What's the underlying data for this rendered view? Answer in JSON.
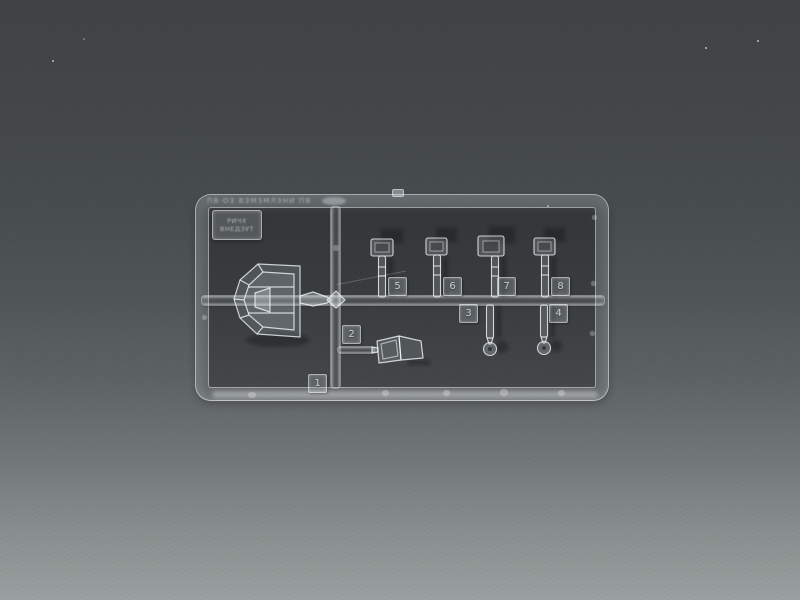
{
  "photo": {
    "subject": "Clear transparent plastic model-kit sprue photographed on a gray gradient backdrop",
    "background_top_color": "#3e4244",
    "background_bottom_color": "#9aa09f",
    "plastic": "transparent clear styrene"
  },
  "sprue": {
    "rail_text": "ПВ·ОЗ ВЗМЗМЛЗНИ ПВ",
    "label_plate": {
      "line1": "РИЧХ",
      "line2": "ВНЕДЗУТ"
    },
    "tab_numbers": [
      "1",
      "2",
      "3",
      "4",
      "5",
      "6",
      "7",
      "8"
    ],
    "parts": [
      {
        "number": "1",
        "name": "faceted canopy glazing"
      },
      {
        "number": "2",
        "name": "windscreen"
      },
      {
        "number": "3",
        "name": "lever with ring end"
      },
      {
        "number": "4",
        "name": "lever with ring end"
      },
      {
        "number": "5",
        "name": "rod with boxed head"
      },
      {
        "number": "6",
        "name": "rod with boxed head"
      },
      {
        "number": "7",
        "name": "rod with boxed head"
      },
      {
        "number": "8",
        "name": "rod with boxed head"
      }
    ]
  }
}
